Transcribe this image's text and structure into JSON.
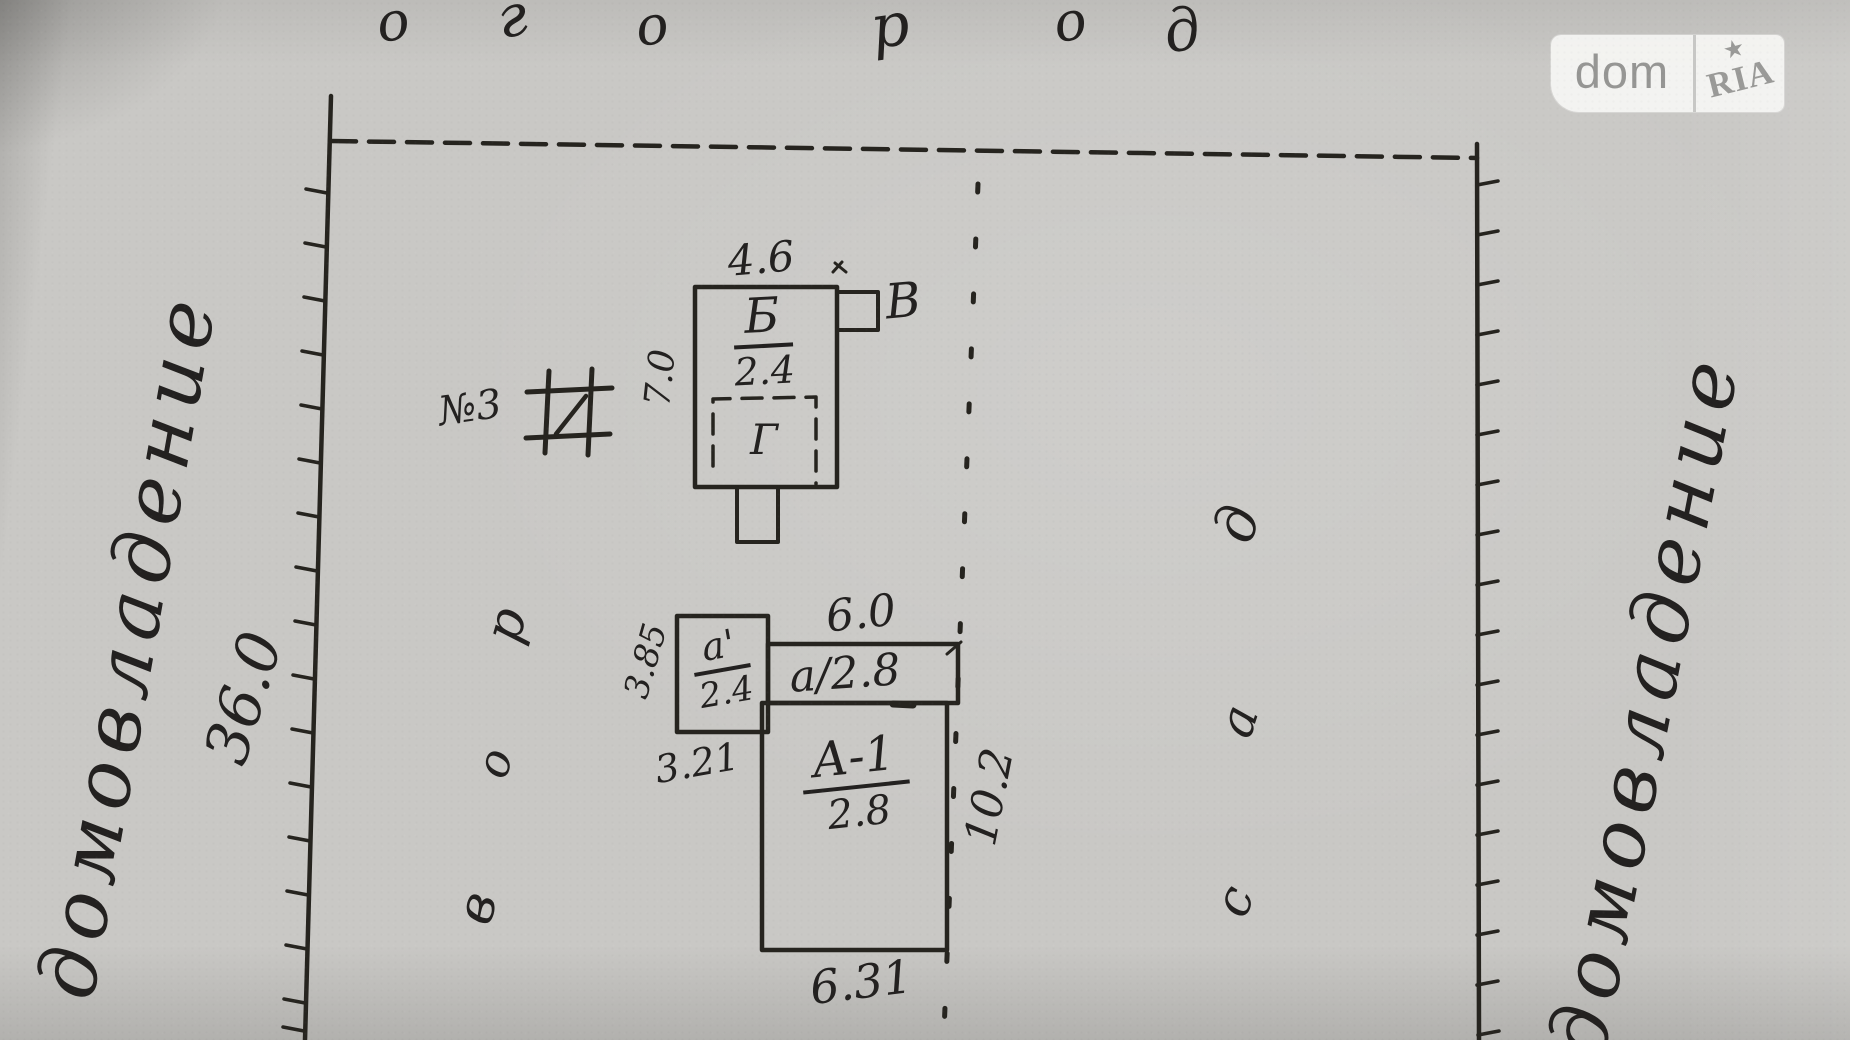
{
  "watermark": {
    "dom": "dom",
    "ria": "RIA",
    "star": "★"
  },
  "labels": {
    "top_word_letters": [
      "о",
      "г",
      "о",
      "р",
      "о",
      "д"
    ],
    "left_ownership": "домовладение",
    "right_ownership": "домовладение",
    "left_length": "36.0",
    "yard_letters": [
      "в",
      "о",
      "р"
    ],
    "garden_letters": [
      "с",
      "а",
      "д"
    ]
  },
  "marker": "№3",
  "building_b": {
    "width": "4.6",
    "depth": "7.0",
    "name": "Б",
    "area": "2.4",
    "annex": "В",
    "inner": "Г"
  },
  "building_a": {
    "annex_name": "а'",
    "annex_area": "2.4",
    "annex_width": "3.85",
    "offset": "3.21",
    "porch_width": "6.0",
    "porch": "а/2.8",
    "name": "А-1",
    "area": "2.8",
    "depth": "10.2",
    "width": "6.31"
  }
}
